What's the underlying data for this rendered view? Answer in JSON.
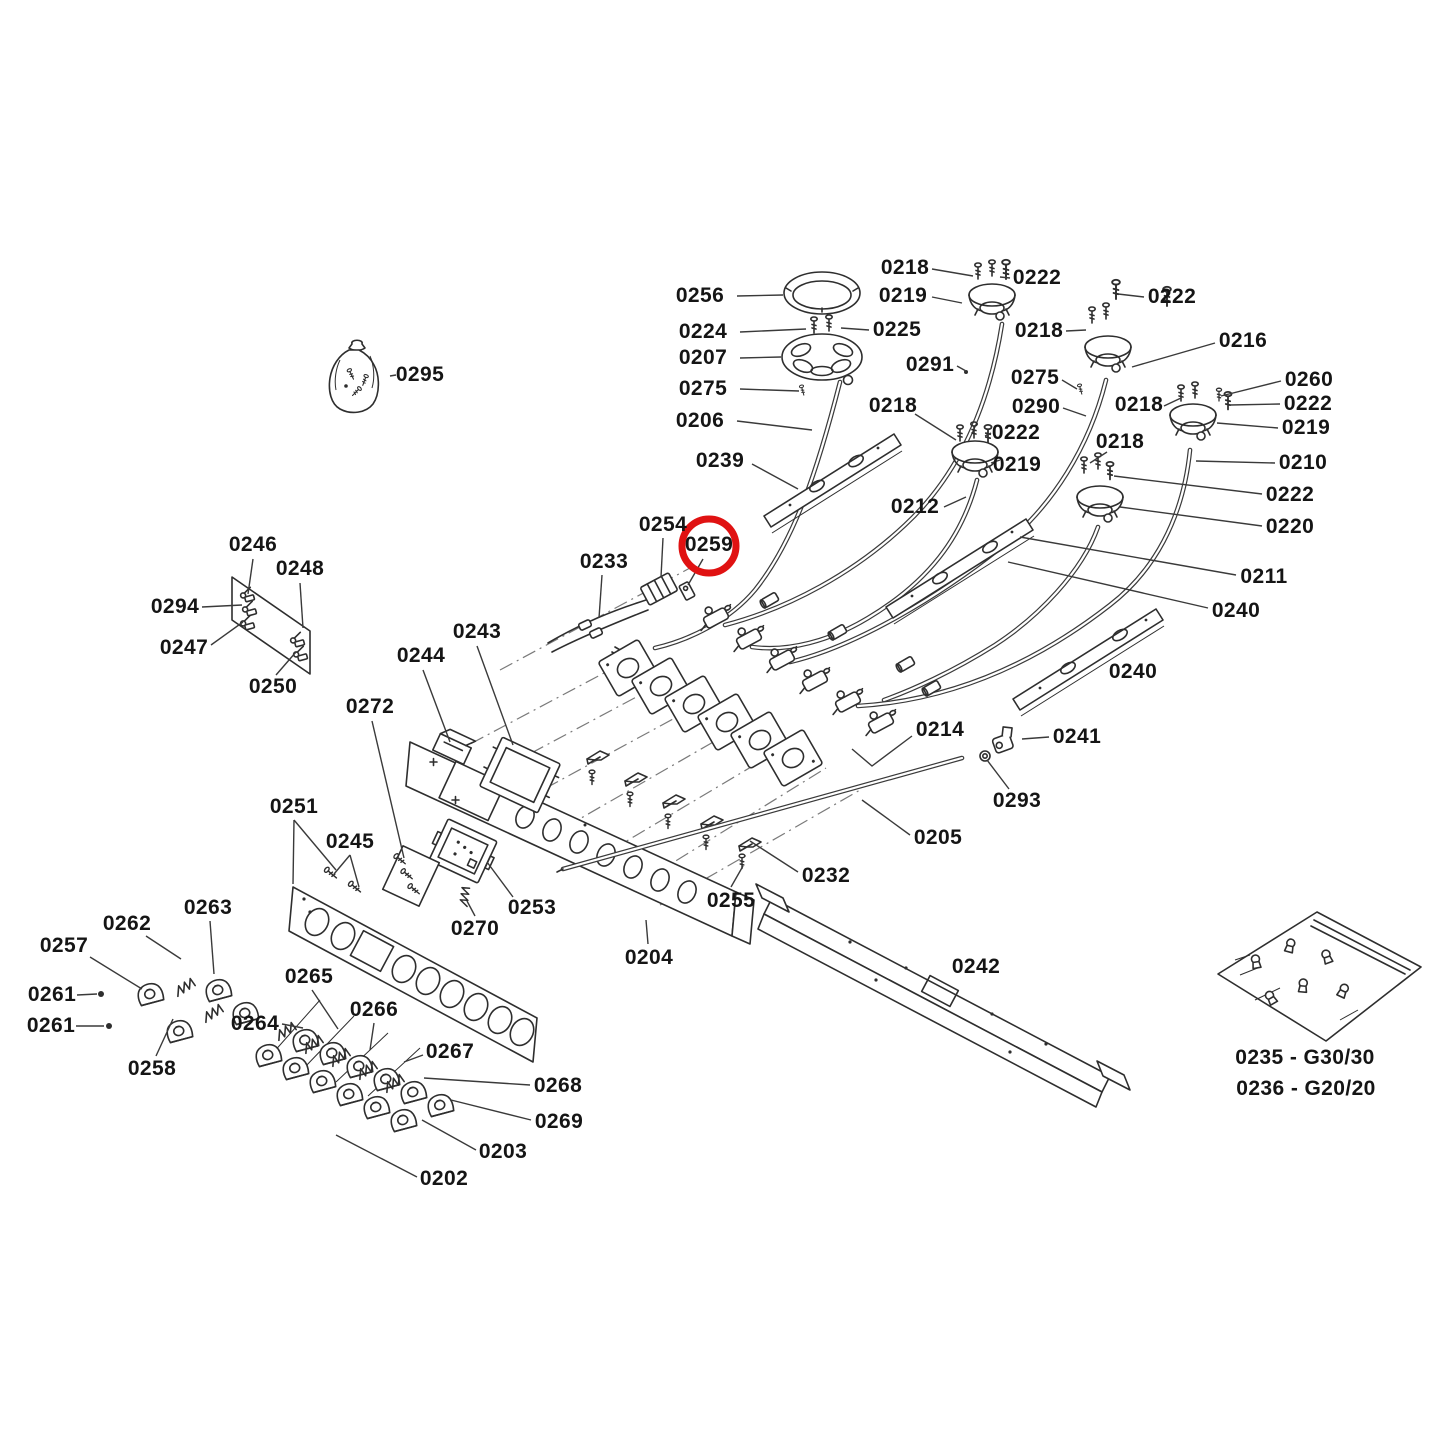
{
  "page": {
    "background": "#ffffff"
  },
  "diagram": {
    "type": "exploded-parts-diagram",
    "subject": "Gas cooktop exploded parts view",
    "colors": {
      "line": "#2e2e2e",
      "leader": "#3a3a3a",
      "background": "#ffffff",
      "highlight": "#e01212",
      "text": "#151515"
    },
    "highlight": {
      "part": "0259",
      "color": "#e01212",
      "cx": 709,
      "cy": 546,
      "r": 27,
      "stroke_width": 7
    },
    "labels": [
      {
        "text": "0256",
        "x": 700,
        "y": 296,
        "leaders": [
          [
            [
              737,
              296
            ],
            [
              783,
              295
            ]
          ]
        ]
      },
      {
        "text": "0224",
        "x": 703,
        "y": 332,
        "leaders": [
          [
            [
              740,
              332
            ],
            [
              806,
              329
            ]
          ]
        ]
      },
      {
        "text": "0207",
        "x": 703,
        "y": 358,
        "leaders": [
          [
            [
              740,
              358
            ],
            [
              781,
              357
            ]
          ]
        ]
      },
      {
        "text": "0275",
        "x": 703,
        "y": 389,
        "leaders": [
          [
            [
              740,
              389
            ],
            [
              799,
              391
            ]
          ]
        ]
      },
      {
        "text": "0206",
        "x": 700,
        "y": 421,
        "leaders": [
          [
            [
              737,
              421
            ],
            [
              812,
              430
            ]
          ]
        ]
      },
      {
        "text": "0239",
        "x": 720,
        "y": 461,
        "leaders": [
          [
            [
              752,
              464
            ],
            [
              798,
              489
            ]
          ]
        ]
      },
      {
        "text": "0218",
        "x": 905,
        "y": 268,
        "leaders": [
          [
            [
              932,
              269
            ],
            [
              973,
              276
            ]
          ]
        ]
      },
      {
        "text": "0219",
        "x": 903,
        "y": 296,
        "leaders": [
          [
            [
              932,
              297
            ],
            [
              962,
              303
            ]
          ]
        ]
      },
      {
        "text": "0222",
        "x": 1037,
        "y": 278,
        "leaders": [
          [
            [
              1010,
              278
            ],
            [
              1000,
              277
            ]
          ]
        ]
      },
      {
        "text": "0225",
        "x": 897,
        "y": 330,
        "leaders": [
          [
            [
              869,
              330
            ],
            [
              841,
              328
            ]
          ]
        ]
      },
      {
        "text": "0291",
        "x": 930,
        "y": 365,
        "leaders": [
          [
            [
              957,
              366
            ],
            [
              966,
              371
            ]
          ]
        ]
      },
      {
        "text": "0218",
        "x": 893,
        "y": 406,
        "leaders": [
          [
            [
              915,
              414
            ],
            [
              956,
              440
            ]
          ]
        ]
      },
      {
        "text": "0222",
        "x": 1016,
        "y": 433,
        "leaders": [
          [
            [
              991,
              433
            ],
            [
              985,
              436
            ]
          ]
        ]
      },
      {
        "text": "0219",
        "x": 1017,
        "y": 465,
        "leaders": [
          [
            [
              991,
              463
            ],
            [
              1000,
              460
            ]
          ]
        ]
      },
      {
        "text": "0212",
        "x": 915,
        "y": 507,
        "leaders": [
          [
            [
              944,
              507
            ],
            [
              966,
              497
            ]
          ]
        ]
      },
      {
        "text": "0222",
        "x": 1172,
        "y": 297,
        "leaders": [
          [
            [
              1144,
              297
            ],
            [
              1118,
              294
            ]
          ]
        ]
      },
      {
        "text": "0218",
        "x": 1039,
        "y": 331,
        "leaders": [
          [
            [
              1066,
              331
            ],
            [
              1086,
              330
            ]
          ]
        ]
      },
      {
        "text": "0216",
        "x": 1243,
        "y": 341,
        "leaders": [
          [
            [
              1215,
              343
            ],
            [
              1132,
              367
            ]
          ]
        ]
      },
      {
        "text": "0275",
        "x": 1035,
        "y": 378,
        "leaders": [
          [
            [
              1062,
              380
            ],
            [
              1077,
              389
            ]
          ]
        ]
      },
      {
        "text": "0260",
        "x": 1309,
        "y": 380,
        "leaders": [
          [
            [
              1281,
              381
            ],
            [
              1221,
              396
            ]
          ]
        ]
      },
      {
        "text": "0290",
        "x": 1036,
        "y": 407,
        "leaders": [
          [
            [
              1063,
              408
            ],
            [
              1086,
              416
            ]
          ]
        ]
      },
      {
        "text": "0218",
        "x": 1139,
        "y": 405,
        "leaders": [
          [
            [
              1164,
              406
            ],
            [
              1181,
              398
            ]
          ]
        ]
      },
      {
        "text": "0222",
        "x": 1308,
        "y": 404,
        "leaders": [
          [
            [
              1280,
              404
            ],
            [
              1230,
              405
            ]
          ]
        ]
      },
      {
        "text": "0219",
        "x": 1306,
        "y": 428,
        "leaders": [
          [
            [
              1278,
              428
            ],
            [
              1217,
              423
            ]
          ]
        ]
      },
      {
        "text": "0218",
        "x": 1120,
        "y": 442,
        "leaders": [
          [
            [
              1107,
              452
            ],
            [
              1090,
              463
            ]
          ]
        ]
      },
      {
        "text": "0210",
        "x": 1303,
        "y": 463,
        "leaders": [
          [
            [
              1275,
              463
            ],
            [
              1196,
              461
            ]
          ]
        ]
      },
      {
        "text": "0222",
        "x": 1290,
        "y": 495,
        "leaders": [
          [
            [
              1262,
              494
            ],
            [
              1114,
              476
            ]
          ]
        ]
      },
      {
        "text": "0220",
        "x": 1290,
        "y": 527,
        "leaders": [
          [
            [
              1262,
              526
            ],
            [
              1120,
              507
            ]
          ]
        ]
      },
      {
        "text": "0211",
        "x": 1264,
        "y": 577,
        "leaders": [
          [
            [
              1236,
              575
            ],
            [
              1020,
              537
            ]
          ]
        ]
      },
      {
        "text": "0240",
        "x": 1236,
        "y": 611,
        "leaders": [
          [
            [
              1208,
              608
            ],
            [
              1008,
              562
            ]
          ]
        ]
      },
      {
        "text": "0240",
        "x": 1133,
        "y": 672
      },
      {
        "text": "0254",
        "x": 663,
        "y": 525,
        "leaders": [
          [
            [
              663,
              538
            ],
            [
              661,
              577
            ]
          ]
        ]
      },
      {
        "text": "0259",
        "x": 709,
        "y": 545,
        "leaders": [
          [
            [
              703,
              559
            ],
            [
              688,
              585
            ]
          ]
        ]
      },
      {
        "text": "0233",
        "x": 604,
        "y": 562,
        "leaders": [
          [
            [
              602,
              575
            ],
            [
              599,
              618
            ]
          ]
        ]
      },
      {
        "text": "0243",
        "x": 477,
        "y": 632,
        "leaders": [
          [
            [
              477,
              646
            ],
            [
              513,
              745
            ]
          ]
        ]
      },
      {
        "text": "0244",
        "x": 421,
        "y": 656,
        "leaders": [
          [
            [
              423,
              670
            ],
            [
              450,
              742
            ]
          ]
        ]
      },
      {
        "text": "0272",
        "x": 370,
        "y": 707,
        "leaders": [
          [
            [
              372,
              721
            ],
            [
              404,
              858
            ]
          ]
        ]
      },
      {
        "text": "0246",
        "x": 253,
        "y": 545,
        "leaders": [
          [
            [
              253,
              559
            ],
            [
              248,
              594
            ]
          ]
        ]
      },
      {
        "text": "0248",
        "x": 300,
        "y": 569,
        "leaders": [
          [
            [
              300,
              583
            ],
            [
              303,
              628
            ]
          ]
        ]
      },
      {
        "text": "0294",
        "x": 175,
        "y": 607,
        "leaders": [
          [
            [
              202,
              607
            ],
            [
              242,
              605
            ]
          ]
        ]
      },
      {
        "text": "0247",
        "x": 184,
        "y": 648,
        "leaders": [
          [
            [
              211,
              645
            ],
            [
              243,
              622
            ]
          ]
        ]
      },
      {
        "text": "0250",
        "x": 273,
        "y": 687,
        "leaders": [
          [
            [
              276,
              675
            ],
            [
              296,
              652
            ]
          ]
        ]
      },
      {
        "text": "0251",
        "x": 294,
        "y": 807,
        "leaders": [
          [
            [
              294,
              820
            ],
            [
              293,
              884
            ]
          ],
          [
            [
              294,
              820
            ],
            [
              336,
              870
            ]
          ]
        ]
      },
      {
        "text": "0245",
        "x": 350,
        "y": 842,
        "leaders": [
          [
            [
              350,
              855
            ],
            [
              334,
              874
            ]
          ],
          [
            [
              350,
              855
            ],
            [
              359,
              887
            ]
          ]
        ]
      },
      {
        "text": "0270",
        "x": 475,
        "y": 929,
        "leaders": [
          [
            [
              475,
              916
            ],
            [
              467,
              901
            ]
          ]
        ]
      },
      {
        "text": "0253",
        "x": 532,
        "y": 908,
        "leaders": [
          [
            [
              513,
              897
            ],
            [
              487,
              862
            ]
          ]
        ]
      },
      {
        "text": "0204",
        "x": 649,
        "y": 958,
        "leaders": [
          [
            [
              648,
              944
            ],
            [
              646,
              920
            ]
          ]
        ]
      },
      {
        "text": "0232",
        "x": 826,
        "y": 876,
        "leaders": [
          [
            [
              798,
              872
            ],
            [
              750,
              841
            ]
          ]
        ]
      },
      {
        "text": "0255",
        "x": 731,
        "y": 901,
        "leaders": [
          [
            [
              731,
              887
            ],
            [
              743,
              866
            ]
          ]
        ]
      },
      {
        "text": "0214",
        "x": 940,
        "y": 730,
        "leaders": [
          [
            [
              912,
              736
            ],
            [
              872,
              766
            ],
            [
              852,
              749
            ]
          ]
        ]
      },
      {
        "text": "0241",
        "x": 1077,
        "y": 737,
        "leaders": [
          [
            [
              1049,
              737
            ],
            [
              1022,
              739
            ]
          ]
        ]
      },
      {
        "text": "0293",
        "x": 1017,
        "y": 801,
        "leaders": [
          [
            [
              1009,
              789
            ],
            [
              987,
              760
            ]
          ]
        ]
      },
      {
        "text": "0205",
        "x": 938,
        "y": 838,
        "leaders": [
          [
            [
              910,
              835
            ],
            [
              862,
              800
            ]
          ]
        ]
      },
      {
        "text": "0242",
        "x": 976,
        "y": 967
      },
      {
        "text": "0262",
        "x": 127,
        "y": 924,
        "leaders": [
          [
            [
              146,
              936
            ],
            [
              181,
              959
            ]
          ]
        ]
      },
      {
        "text": "0263",
        "x": 208,
        "y": 908,
        "leaders": [
          [
            [
              210,
              921
            ],
            [
              214,
              974
            ]
          ]
        ]
      },
      {
        "text": "0257",
        "x": 64,
        "y": 946,
        "leaders": [
          [
            [
              90,
              957
            ],
            [
              142,
              989
            ]
          ]
        ]
      },
      {
        "text": "0261",
        "x": 52,
        "y": 995,
        "leaders": [
          [
            [
              77,
              995
            ],
            [
              97,
              994
            ]
          ]
        ]
      },
      {
        "text": "0261",
        "x": 51,
        "y": 1026,
        "leaders": [
          [
            [
              76,
              1026
            ],
            [
              104,
              1026
            ]
          ]
        ]
      },
      {
        "text": "0258",
        "x": 152,
        "y": 1069,
        "leaders": [
          [
            [
              156,
              1056
            ],
            [
              173,
              1019
            ]
          ]
        ]
      },
      {
        "text": "0264",
        "x": 255,
        "y": 1024,
        "leaders": [
          [
            [
              282,
              1024
            ],
            [
              303,
              1028
            ]
          ]
        ]
      },
      {
        "text": "0265",
        "x": 309,
        "y": 977,
        "leaders": [
          [
            [
              312,
              990
            ],
            [
              338,
              1029
            ]
          ]
        ]
      },
      {
        "text": "0266",
        "x": 374,
        "y": 1010,
        "leaders": [
          [
            [
              374,
              1023
            ],
            [
              370,
              1050
            ]
          ]
        ]
      },
      {
        "text": "0267",
        "x": 450,
        "y": 1052,
        "leaders": [
          [
            [
              423,
              1055
            ],
            [
              404,
              1062
            ]
          ]
        ]
      },
      {
        "text": "0268",
        "x": 558,
        "y": 1086,
        "leaders": [
          [
            [
              530,
              1085
            ],
            [
              424,
              1078
            ]
          ]
        ]
      },
      {
        "text": "0269",
        "x": 559,
        "y": 1122,
        "leaders": [
          [
            [
              531,
              1120
            ],
            [
              451,
              1100
            ]
          ]
        ]
      },
      {
        "text": "0203",
        "x": 503,
        "y": 1152,
        "leaders": [
          [
            [
              476,
              1150
            ],
            [
              422,
              1120
            ]
          ]
        ]
      },
      {
        "text": "0202",
        "x": 444,
        "y": 1179,
        "leaders": [
          [
            [
              417,
              1177
            ],
            [
              336,
              1135
            ]
          ]
        ]
      },
      {
        "text": "0295",
        "x": 420,
        "y": 375,
        "leaders": [
          [
            [
              396,
              375
            ],
            [
              390,
              376
            ]
          ]
        ]
      }
    ],
    "notes": [
      {
        "text": "0235 - G30/30",
        "x": 1305,
        "y": 1058
      },
      {
        "text": "0236 - G20/20",
        "x": 1306,
        "y": 1089
      }
    ]
  }
}
